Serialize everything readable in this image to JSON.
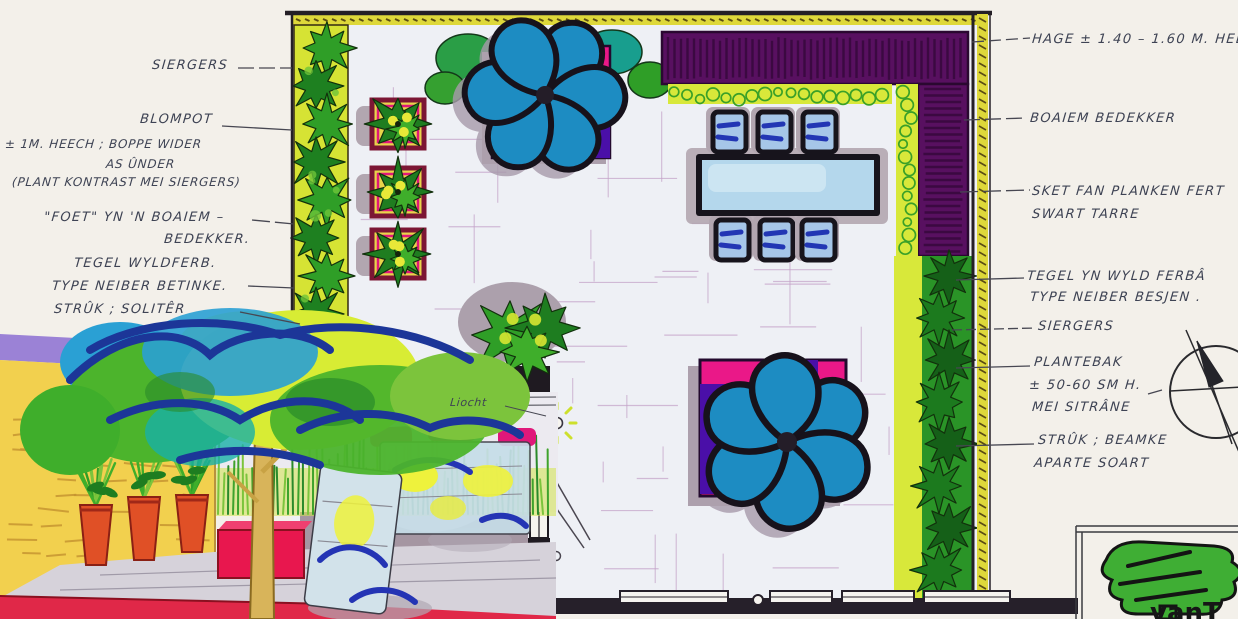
{
  "document": {
    "title": "Hand-drawn garden design plan with Frisian annotations",
    "logo_text": "vanT"
  },
  "annotations": {
    "left": [
      {
        "id": "siergers",
        "lines": [
          "SIERGERS"
        ]
      },
      {
        "id": "blompot",
        "lines": [
          "BLOMPOT",
          "± 1M. HEECH ; BOPPE WIDER",
          "AS ÛNDER",
          "(PLANT KONTRAST MEI SIERGERS)"
        ]
      },
      {
        "id": "foet-boaiem",
        "lines": [
          "\"FOET\" YN 'N BOAIEM –",
          "BEDEKKER."
        ]
      },
      {
        "id": "tegel",
        "lines": [
          "TEGEL WYLDFERB.",
          "TYPE NEIBER BETINKE."
        ]
      },
      {
        "id": "struk-soliter",
        "lines": [
          "STRÛK ; SOLITÊR"
        ]
      }
    ],
    "right": [
      {
        "id": "hage",
        "lines": [
          "HAGE ± 1.40 – 1.60 M. HEEC"
        ]
      },
      {
        "id": "boaiem-bedekker",
        "lines": [
          "BOAIEM BEDEKKER"
        ]
      },
      {
        "id": "sket",
        "lines": [
          "SKET FAN PLANKEN FERT",
          "SWART TARRE"
        ]
      },
      {
        "id": "tegel-wyld",
        "lines": [
          "TEGEL YN WYLD FERBÂ",
          "TYPE NEIBER BESJEN ."
        ]
      },
      {
        "id": "siergers",
        "lines": [
          "SIERGERS"
        ]
      },
      {
        "id": "plantebak",
        "lines": [
          "PLANTEBAK",
          "± 50-60 SM H.",
          "MEI SITRÂNE"
        ]
      },
      {
        "id": "struk-beamke",
        "lines": [
          "STRÛK ; BEAMKE",
          "APARTE SOART"
        ]
      }
    ],
    "plan": [
      {
        "id": "liocht",
        "text": "Liocht"
      }
    ]
  },
  "drawing": {
    "elements": [
      "ornamental-grass-bed",
      "flower-pots",
      "ground-cover",
      "wild-bond-paving",
      "solitary-shrub",
      "hedge",
      "black-tarred-plank-screen",
      "dining-table-six-chairs",
      "feature-tree-in-magenta-planter",
      "seating-edge-planter-box",
      "house-footprint",
      "wall-light",
      "door-swing",
      "compass-north-arrow",
      "perspective-sketch",
      "title-block-tree-logo"
    ]
  },
  "palette": {
    "paper": "#f3f0ea",
    "ink": "#3e4354",
    "plan_line": "#241f26",
    "hedge_green": "#2f9e27",
    "grass_dark_green": "#1e7d20",
    "groundcover_yellow": "#dce43a",
    "screen_purple": "#581060",
    "planter_magenta": "#ea1888",
    "accent_purple": "#4a0fa8",
    "tree_canopy_blue": "#1d8cc2",
    "table_blue": "#b4d7ec",
    "chair_mark_blue": "#2236b4",
    "shadow_mauve": "#ada0ad",
    "sketch_wall_yellow": "#f2d04e",
    "sketch_pot_red": "#e05026",
    "sketch_planter_red": "#e8174e",
    "sketch_paving_red": "#e02848",
    "sketch_canopy_outline": "#1c3698",
    "logo_green": "#3fae34"
  }
}
